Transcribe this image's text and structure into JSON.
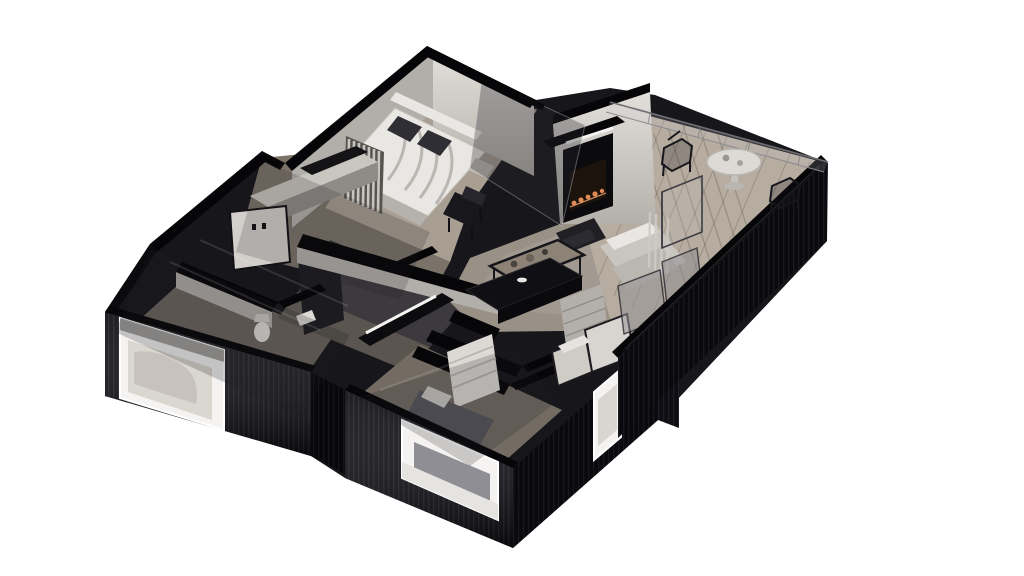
{
  "scene": {
    "kind": "isometric-3d-floor-plan-render",
    "background": "#ffffff",
    "building": {
      "exterior_finish": "dark ribbed cladding",
      "cutaway": "smoked-glass upper walls",
      "orientation": "dimetric, north corner top-center"
    },
    "rooms": [
      {
        "name": "master-bedroom",
        "position": "top",
        "furniture": [
          "double-bed",
          "white-duvet",
          "dark-pillows",
          "curtain-panel",
          "black-side-chair",
          "dresser-cabinets"
        ]
      },
      {
        "name": "living-room",
        "position": "center-right",
        "furniture": [
          "wall-fireplace",
          "armchair",
          "sofa",
          "coffee-table-with-cups",
          "rug"
        ]
      },
      {
        "name": "kitchen",
        "position": "center",
        "furniture": [
          "black-island",
          "counter-with-led-strip",
          "tall-cabinet",
          "shelf-unit",
          "storage-boxes"
        ]
      },
      {
        "name": "balcony",
        "position": "right",
        "furniture": [
          "round-table",
          "wire-chair-left",
          "wire-chair-right",
          "glass-railing",
          "drying-rack"
        ]
      },
      {
        "name": "bedroom-2",
        "position": "bottom-left",
        "furniture": [
          "bed"
        ]
      },
      {
        "name": "bedroom-3",
        "position": "bottom-center",
        "furniture": [
          "bed",
          "towel-shelf",
          "wardrobe"
        ]
      },
      {
        "name": "bathroom",
        "position": "left-center",
        "furniture": [
          "toilet",
          "washbasin"
        ]
      },
      {
        "name": "hallway",
        "position": "center-left",
        "furniture": [
          "small-cabinet"
        ]
      }
    ],
    "windows": [
      {
        "name": "window-bedroom-2",
        "wall": "southwest"
      },
      {
        "name": "window-bedroom-3",
        "wall": "southwest"
      },
      {
        "name": "window-corner",
        "wall": "southeast"
      }
    ],
    "colors": {
      "background": "#ffffff",
      "facade_dark": "#0d0d12",
      "facade_rib": "#1e1e26",
      "wall_cap": "#060608",
      "wall_light": "#d6d3ce",
      "wall_mid": "#b2afaa",
      "wall_shadow": "#8f8c87",
      "floor_wood": "#a89e92",
      "floor_wood_dark": "#7b7369",
      "floor_kitchen": "#3c3a3e",
      "floor_balcony": "#b7aca0",
      "glass_tint": "rgba(40,40,48,0.32)",
      "bed_white": "#e9e7e3",
      "duvet_gray": "#b5b1ac",
      "pillow_dark": "#2e2e34",
      "furniture_black": "#17171c",
      "table_wood": "#8d8276",
      "flame_orange": "#e08a55",
      "led_white": "#f5f4f1",
      "window_white": "#f4f3f1",
      "railing_gray": "#8a8a8f"
    }
  }
}
